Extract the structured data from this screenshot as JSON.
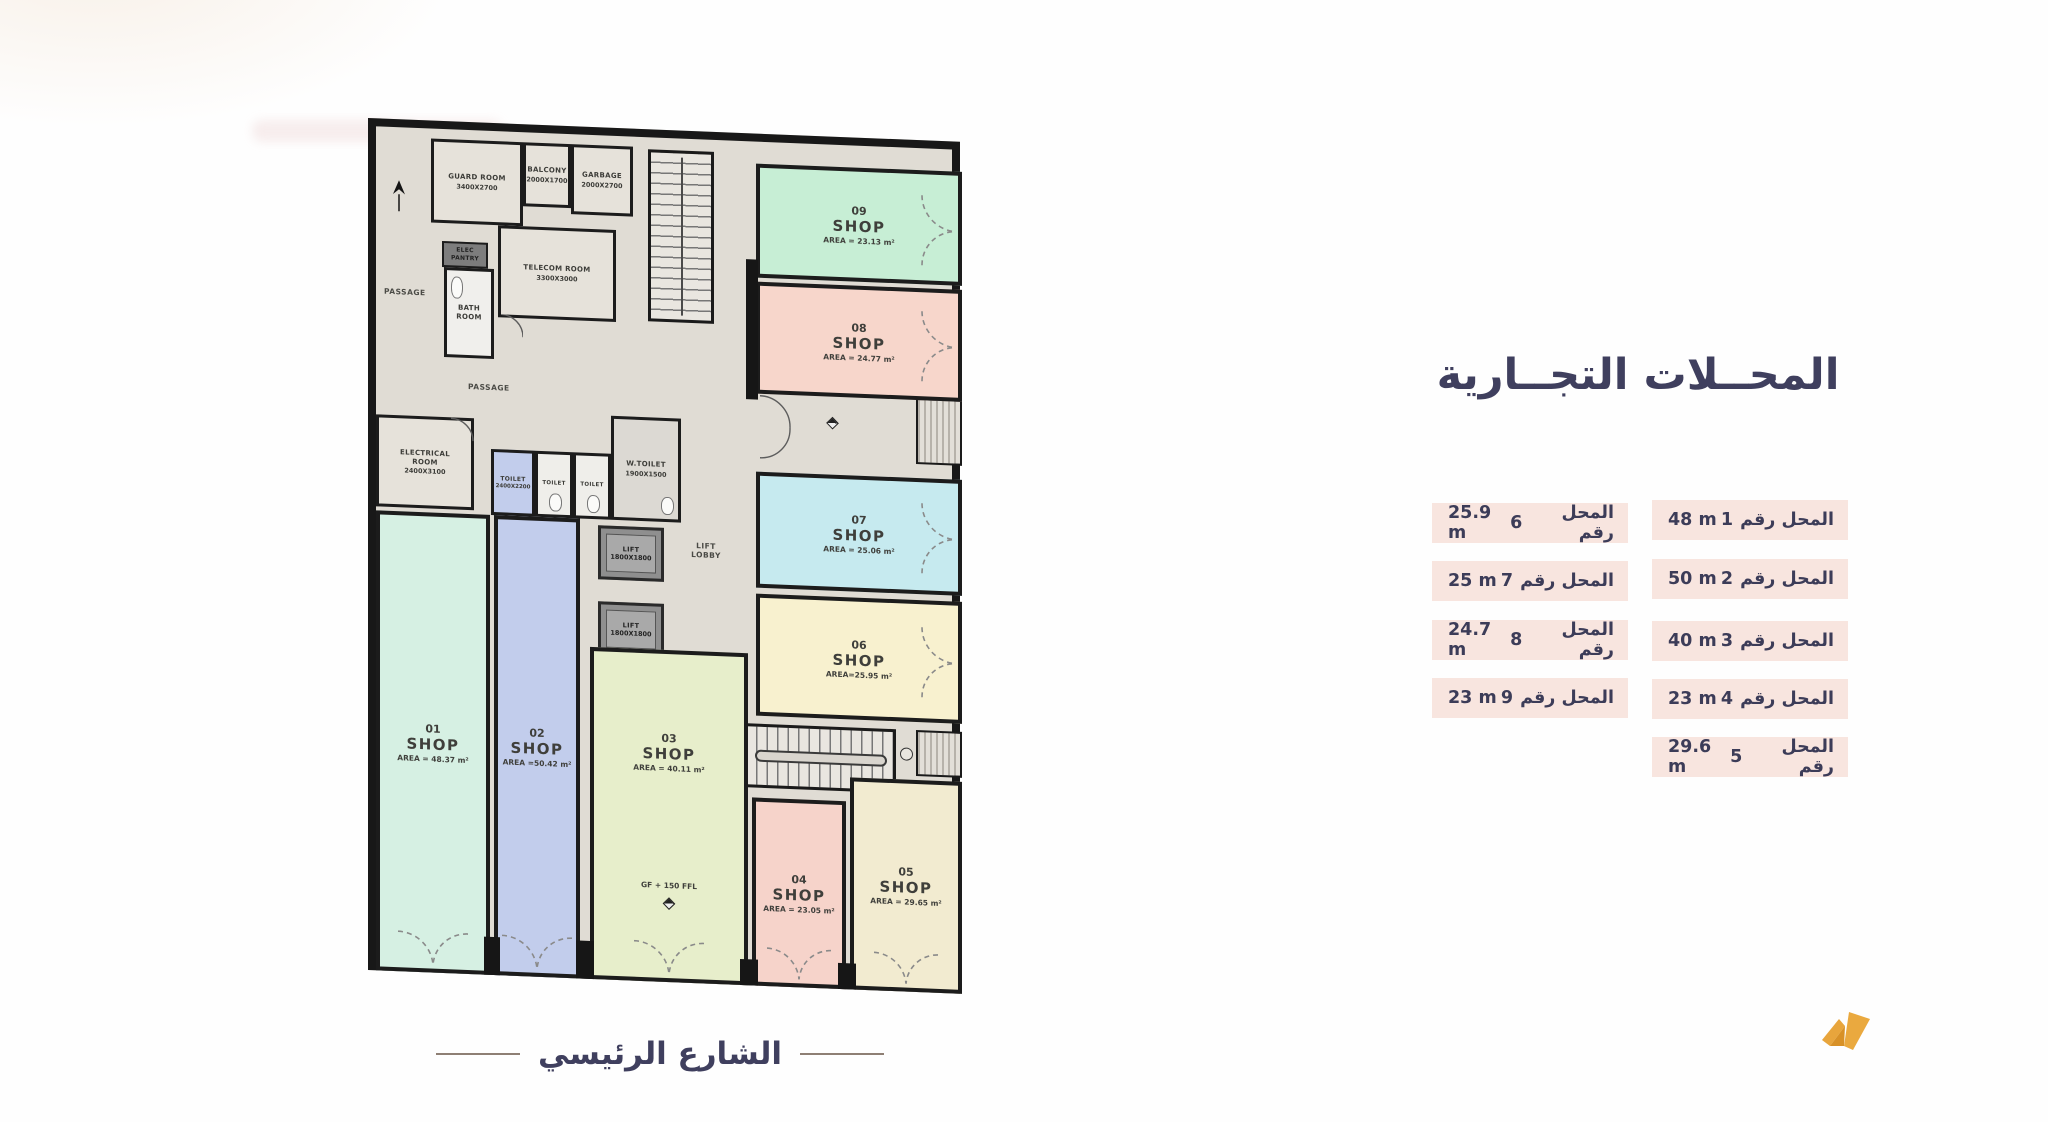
{
  "legend": {
    "title": "المحــلات التجــارية",
    "right": [
      {
        "label": "المحل رقم",
        "num": "1",
        "area": "48 m"
      },
      {
        "label": "المحل رقم",
        "num": "2",
        "area": "50 m"
      },
      {
        "label": "المحل رقم",
        "num": "3",
        "area": "40 m"
      },
      {
        "label": "المحل رقم",
        "num": "4",
        "area": "23 m"
      },
      {
        "label": "المحل رقم",
        "num": "5",
        "area": "29.6 m"
      }
    ],
    "left": [
      {
        "label": "المحل رقم",
        "num": "6",
        "area": "25.9 m"
      },
      {
        "label": "المحل رقم",
        "num": "7",
        "area": "25 m"
      },
      {
        "label": "المحل رقم",
        "num": "8",
        "area": "24.7 m"
      },
      {
        "label": "المحل رقم",
        "num": "9",
        "area": "23 m"
      }
    ]
  },
  "street": {
    "label": "الشارع الرئيسي"
  },
  "plan": {
    "shops": {
      "s01": {
        "num": "01",
        "type": "SHOP",
        "area": "AREA = 48.37 m²"
      },
      "s02": {
        "num": "02",
        "type": "SHOP",
        "area": "AREA =50.42 m²"
      },
      "s03": {
        "num": "03",
        "type": "SHOP",
        "area": "AREA = 40.11 m²",
        "note": "GF + 150 FFL"
      },
      "s04": {
        "num": "04",
        "type": "SHOP",
        "area": "AREA = 23.05 m²"
      },
      "s05": {
        "num": "05",
        "type": "SHOP",
        "area": "AREA = 29.65 m²"
      },
      "s06": {
        "num": "06",
        "type": "SHOP",
        "area": "AREA=25.95 m²"
      },
      "s07": {
        "num": "07",
        "type": "SHOP",
        "area": "AREA = 25.06 m²"
      },
      "s08": {
        "num": "08",
        "type": "SHOP",
        "area": "AREA = 24.77 m²"
      },
      "s09": {
        "num": "09",
        "type": "SHOP",
        "area": "AREA = 23.13 m²"
      }
    },
    "rooms": {
      "guard": {
        "name": "GUARD ROOM",
        "dims": "3400X2700"
      },
      "balcony": {
        "name": "BALCONY",
        "dims": "2000X1700"
      },
      "garbage": {
        "name": "GARBAGE",
        "dims": "2000X2700"
      },
      "telecom": {
        "name": "TELECOM ROOM",
        "dims": "3300X3000"
      },
      "electrical": {
        "name": "ELECTRICAL ROOM",
        "dims": "2400X3100"
      },
      "toilet_blue": {
        "name": "TOILET",
        "dims": "2400X2200"
      },
      "toilet_a": {
        "name": "TOILET"
      },
      "toilet_b": {
        "name": "TOILET"
      },
      "wtoilet": {
        "name": "W.TOILET",
        "dims": "1900X1500"
      },
      "bath": {
        "name": "BATH ROOM"
      },
      "pantry": {
        "name": "ELEC PANTRY"
      },
      "lift1": {
        "name": "LIFT",
        "dims": "1800X1800"
      },
      "lift2": {
        "name": "LIFT",
        "dims": "1800X1800"
      },
      "lobby": {
        "name": "LIFT LOBBY"
      },
      "passage1": {
        "name": "PASSAGE"
      },
      "passage2": {
        "name": "PASSAGE"
      }
    }
  },
  "colors": {
    "shop01": "#d6f0e3",
    "shop02": "#c2cdec",
    "shop03": "#e7eecb",
    "shop04": "#f6d3ca",
    "shop05": "#f2ebd0",
    "shop06": "#f8f1cf",
    "shop07": "#c6eaef",
    "shop08": "#f7d6cb",
    "shop09": "#c7eed5",
    "legend_row_bg": "#f8e5df",
    "navy_text": "#3f3f5e",
    "wall": "#181818",
    "floor": "#e0dcd4",
    "logo_orange": "#e8a53c"
  }
}
